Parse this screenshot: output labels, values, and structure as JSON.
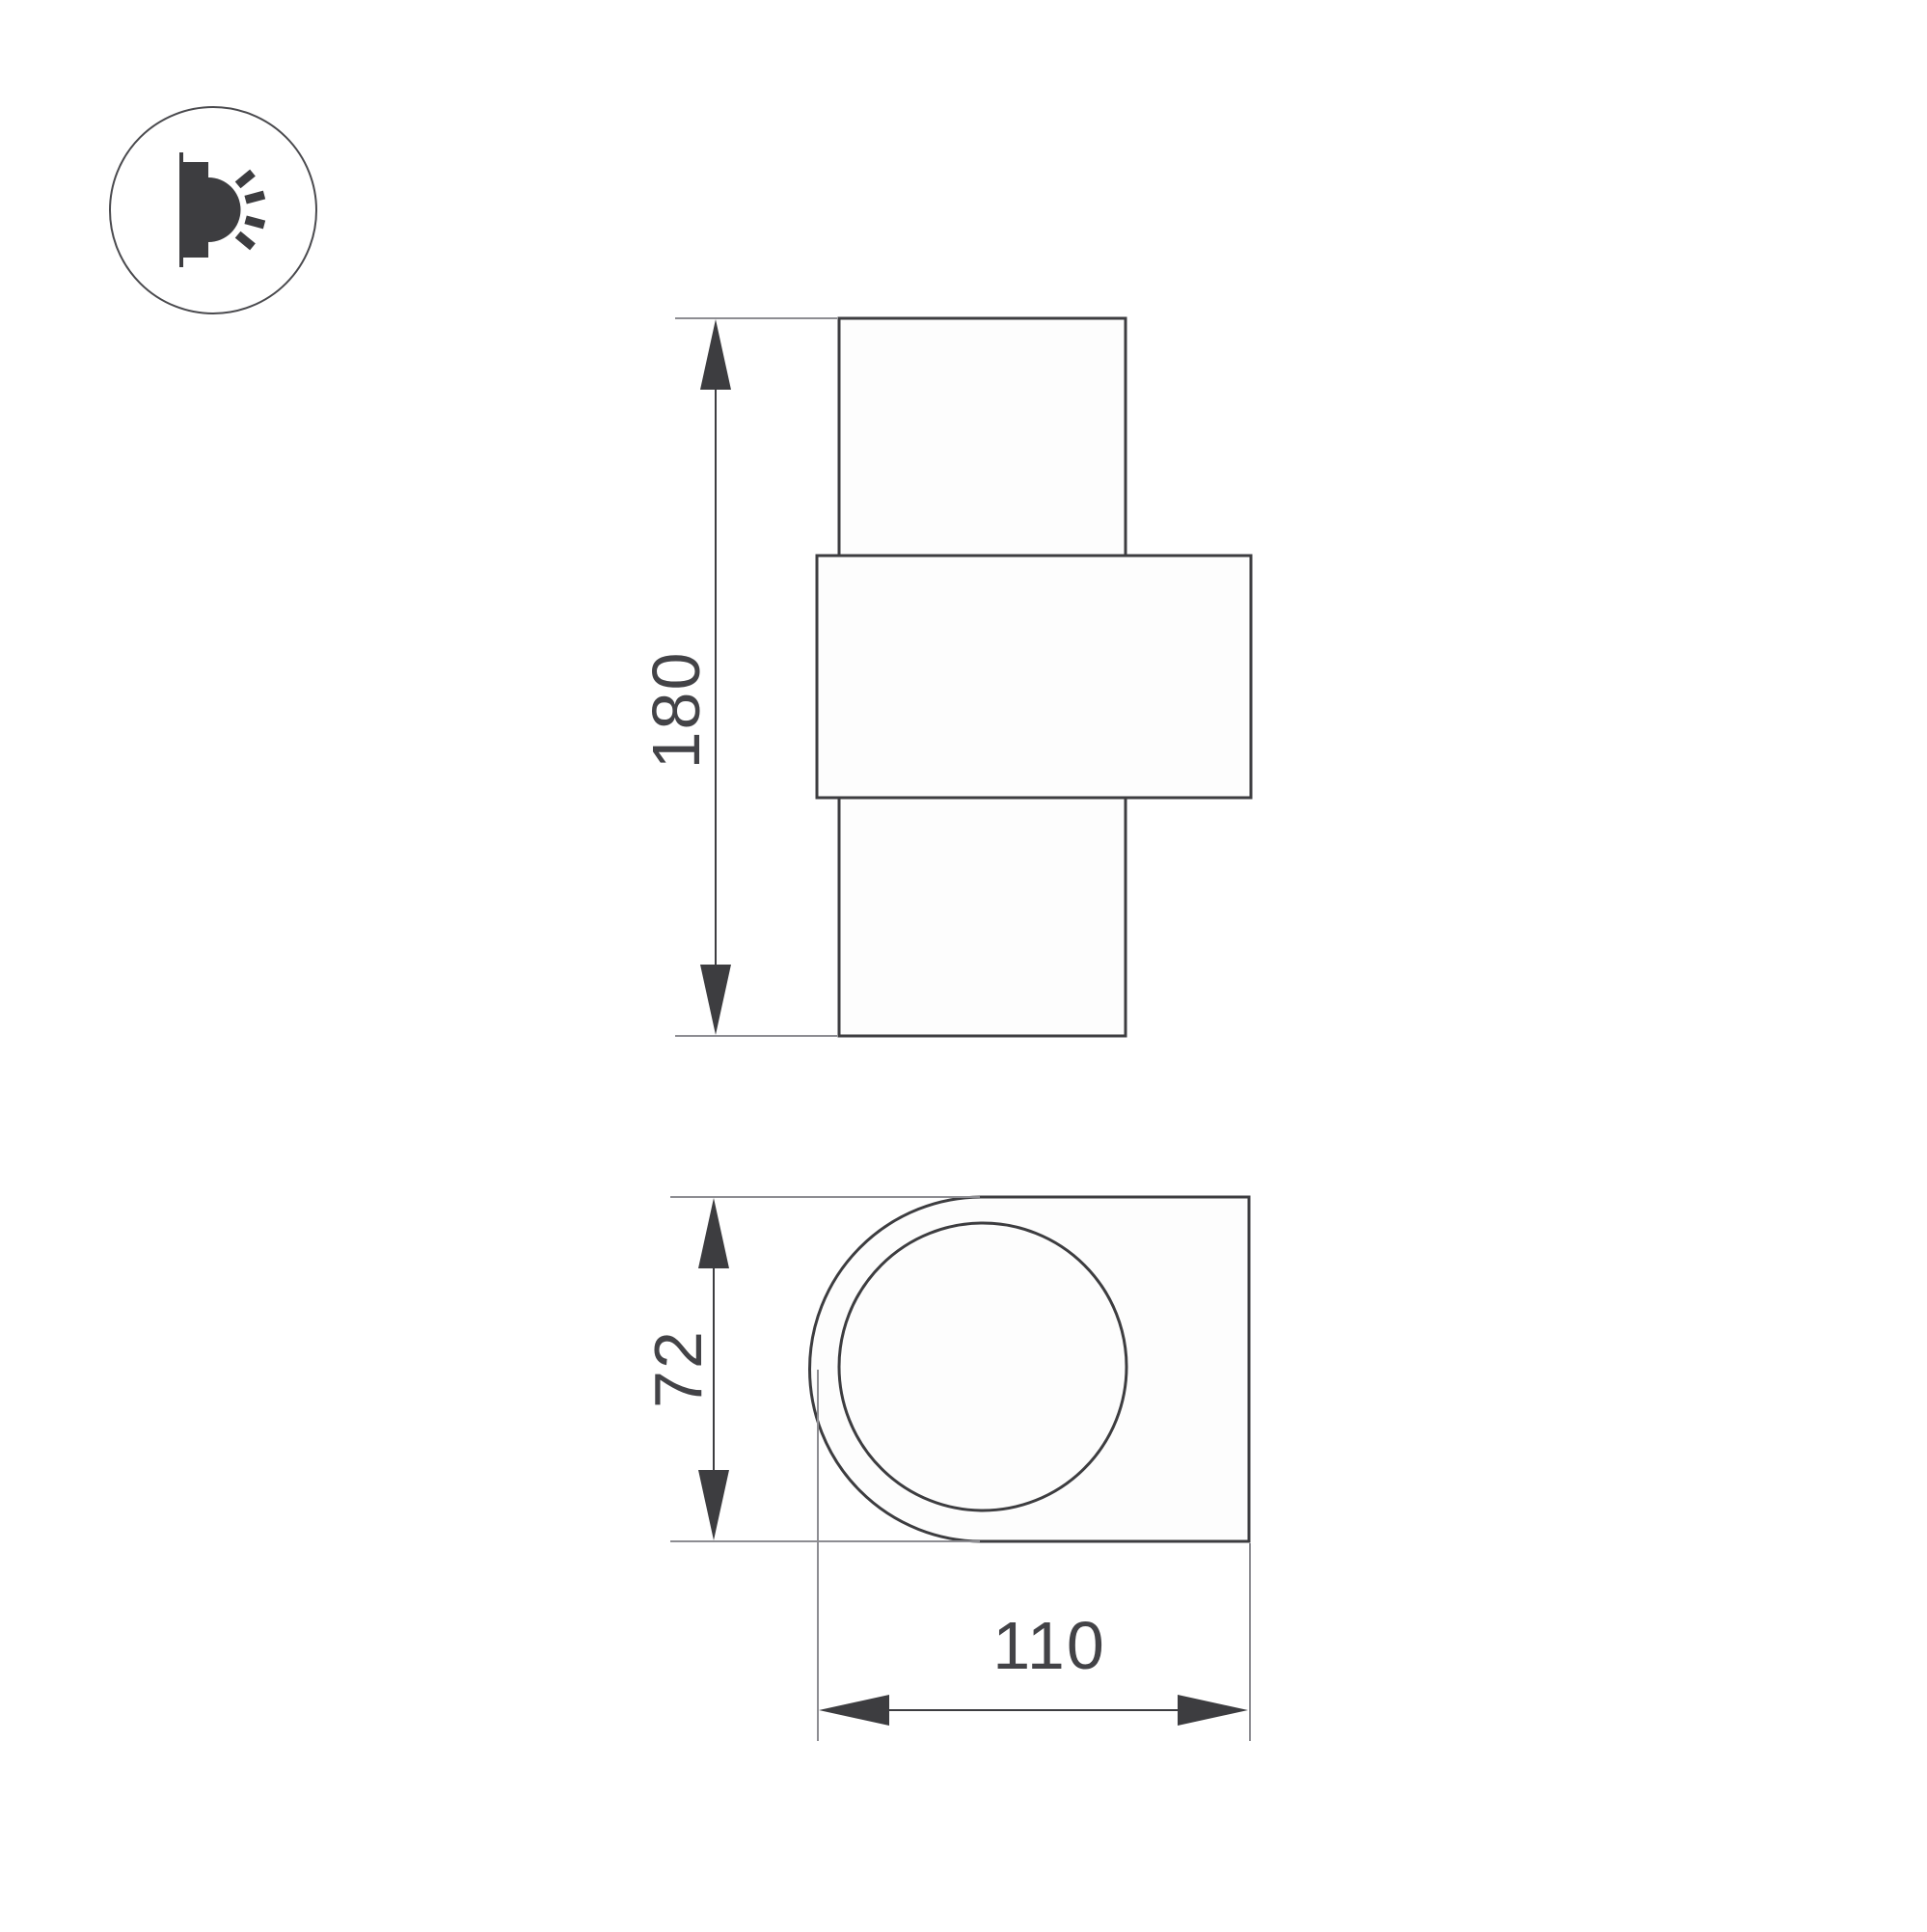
{
  "drawing": {
    "kind": "luminaire-dimension-drawing",
    "background_color": "#ffffff",
    "outline_color": "#3d3d40",
    "extension_line_color": "#8d8d92",
    "text_color": "#434347"
  },
  "legend_icon": {
    "name": "wall-lamp-side-light-icon"
  },
  "front_view": {
    "height_dimension": {
      "label": "180"
    }
  },
  "side_view": {
    "height_dimension": {
      "label": "72"
    },
    "width_dimension": {
      "label": "110"
    }
  }
}
